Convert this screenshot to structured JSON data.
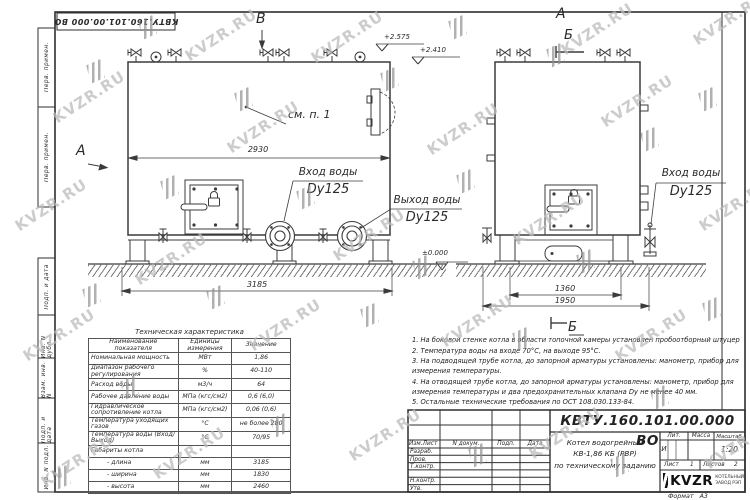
{
  "watermark": {
    "text": "KVZR.RU"
  },
  "frame": {
    "stamp_rotated_top": "КВТУ.160.101.00.000 ВО",
    "side_fields": [
      {
        "label": "Перв. примен."
      },
      {
        "label": "Перв. примен."
      },
      {
        "label": "Подп. и дата"
      },
      {
        "label": "Инв. N дубл."
      },
      {
        "label": "Взам. инв. N"
      },
      {
        "label": "Подп. и дата"
      },
      {
        "label": "Инв. N подл."
      }
    ]
  },
  "drawing": {
    "view_b_label": "В",
    "view_a_label_left": "А",
    "view_a_label_right": "А",
    "section_b_top": "Б",
    "section_b_bottom": "Б",
    "see_note": "см. п. 1",
    "elev_1": "+2.575",
    "elev_2": "+2.410",
    "elev_0": "±0.000",
    "dim_body": "2930",
    "dim_base": "3185",
    "dim_1360": "1360",
    "dim_1950": "1950",
    "inlet_left": {
      "line1": "Вход воды",
      "line2": "Dy125"
    },
    "outlet_left": {
      "line1": "Выход воды",
      "line2": "Dy125"
    },
    "inlet_right": {
      "line1": "Вход воды",
      "line2": "Dy125"
    }
  },
  "table": {
    "title": "Техническая характеристика",
    "headers": [
      "Наименование показателя",
      "Единицы измерения",
      "Значение"
    ],
    "rows": [
      [
        "Номинальная мощность",
        "МВт",
        "1,86"
      ],
      [
        "Диапазон рабочего регулирования",
        "%",
        "40-110"
      ],
      [
        "Расход воды",
        "м3/ч",
        "64"
      ],
      [
        "Рабочее давление воды",
        "МПа (кгс/см2)",
        "0,6 (6,0)"
      ],
      [
        "Гидравлическое сопротивление котла",
        "МПа (кгс/см2)",
        "0,06 (0,6)"
      ],
      [
        "Температура уходящих газов",
        "°С",
        "не более 280"
      ],
      [
        "Температура воды (Вход/Выход)",
        "°С",
        "70/95"
      ],
      [
        "Габариты котла",
        "",
        ""
      ],
      [
        "- длина",
        "мм",
        "3185"
      ],
      [
        "- ширина",
        "мм",
        "1830"
      ],
      [
        "- высота",
        "мм",
        "2460"
      ]
    ]
  },
  "notes": {
    "items": [
      "1.  На боковой стенке котла в области топочной камеры установлен пробоотборный штуцер",
      "2.  Температура воды на входе 70°С, на выходе 95°С.",
      "3.  На подводящей трубе котла, до запорной арматуры установлены: манометр, прибор для измерения температуры.",
      "4.  На отводящей трубе котла, до запорной арматуры установлены: манометр, прибор для измерения температуры и два предохранительных клапана Dу не менее 40 мм.",
      "5.  Остальные технические требования по ОСТ 108.030.133-84."
    ]
  },
  "title_block": {
    "doc_number": "КВТУ.160.101.00.000  ВО",
    "product_line1": "Котел водогрейный",
    "product_line2": "КВ-1,86 КБ (РВР)",
    "product_line3": "по техническому заданию",
    "col_izm": "Изм.Лист",
    "col_doc": "N докум.",
    "col_sign": "Подп.",
    "col_date": "Дата",
    "row_razrab": "Разраб.",
    "row_prov": "Пров.",
    "row_tkontr": "Т.контр.",
    "row_nkontr": "Н.контр.",
    "row_utv": "Утв.",
    "lit_label": "Лит.",
    "lit_value": "И",
    "mass_label": "Масса",
    "scale_label": "Масштаб",
    "scale_value": "1:20",
    "sheet_label": "Лист",
    "sheet_value": "1",
    "sheets_label": "Листов",
    "sheets_value": "2",
    "company": "KVZR",
    "company_sub1": "КОТЕЛЬНЫЙ",
    "company_sub2": "ЗАВОД РЭП",
    "format_label": "Формат",
    "format_value": "А3"
  }
}
